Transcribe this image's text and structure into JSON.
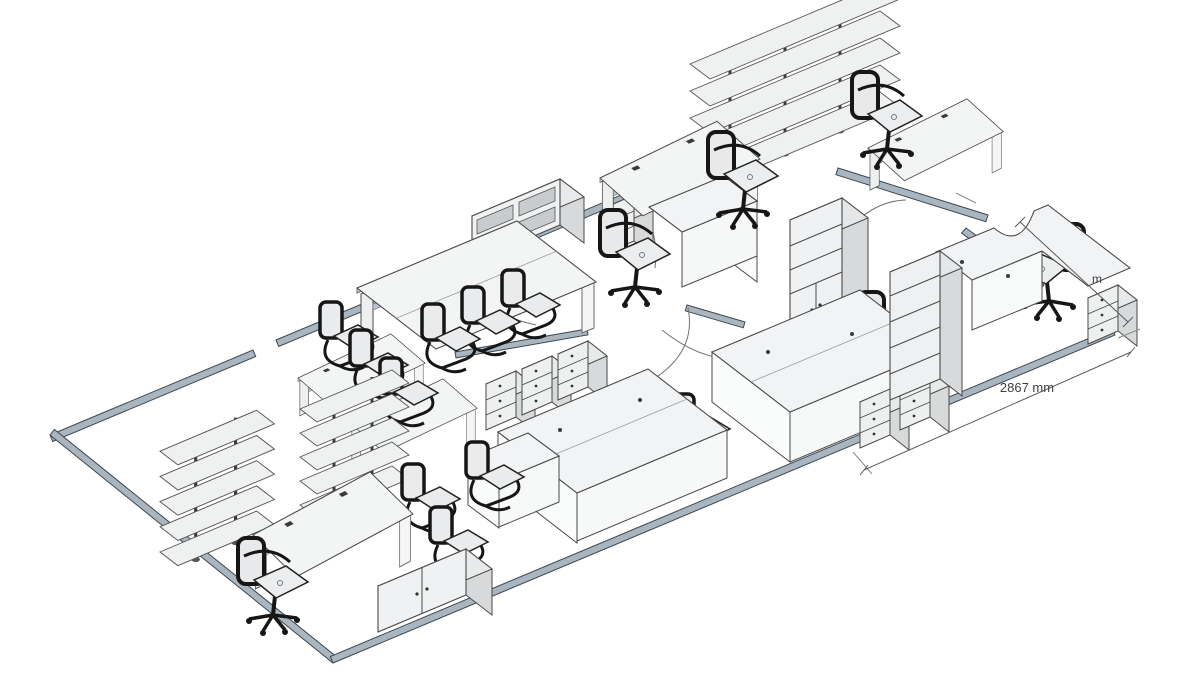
{
  "scene": {
    "description": "Isometric 3D render of an open-plan office floor plan",
    "background_color": "#ffffff",
    "colors": {
      "wall_fill": "#a9b6c0",
      "wall_outline": "#3d4852",
      "furniture_top": "#f2f3f4",
      "furniture_side": "#d7d9da",
      "furniture_front": "#eef0f0",
      "outline": "#4a4a4a",
      "chair_frame": "#161616",
      "chair_seat": "#eaebec",
      "accent_rail": "#b9c5ce",
      "dimension": "#4d4d4d"
    },
    "inventory": {
      "desks": 11,
      "meeting_tables": 1,
      "office_chairs": 6,
      "visitor_chairs": 11,
      "shelving_racks": 3,
      "tall_cabinets": 2,
      "sideboards": 2,
      "pedestals": 7,
      "door_swings": 5,
      "dimension_lines": 2
    }
  },
  "annotations": {
    "dimension_primary": "2867 mm",
    "dimension_secondary_partial": "m"
  }
}
